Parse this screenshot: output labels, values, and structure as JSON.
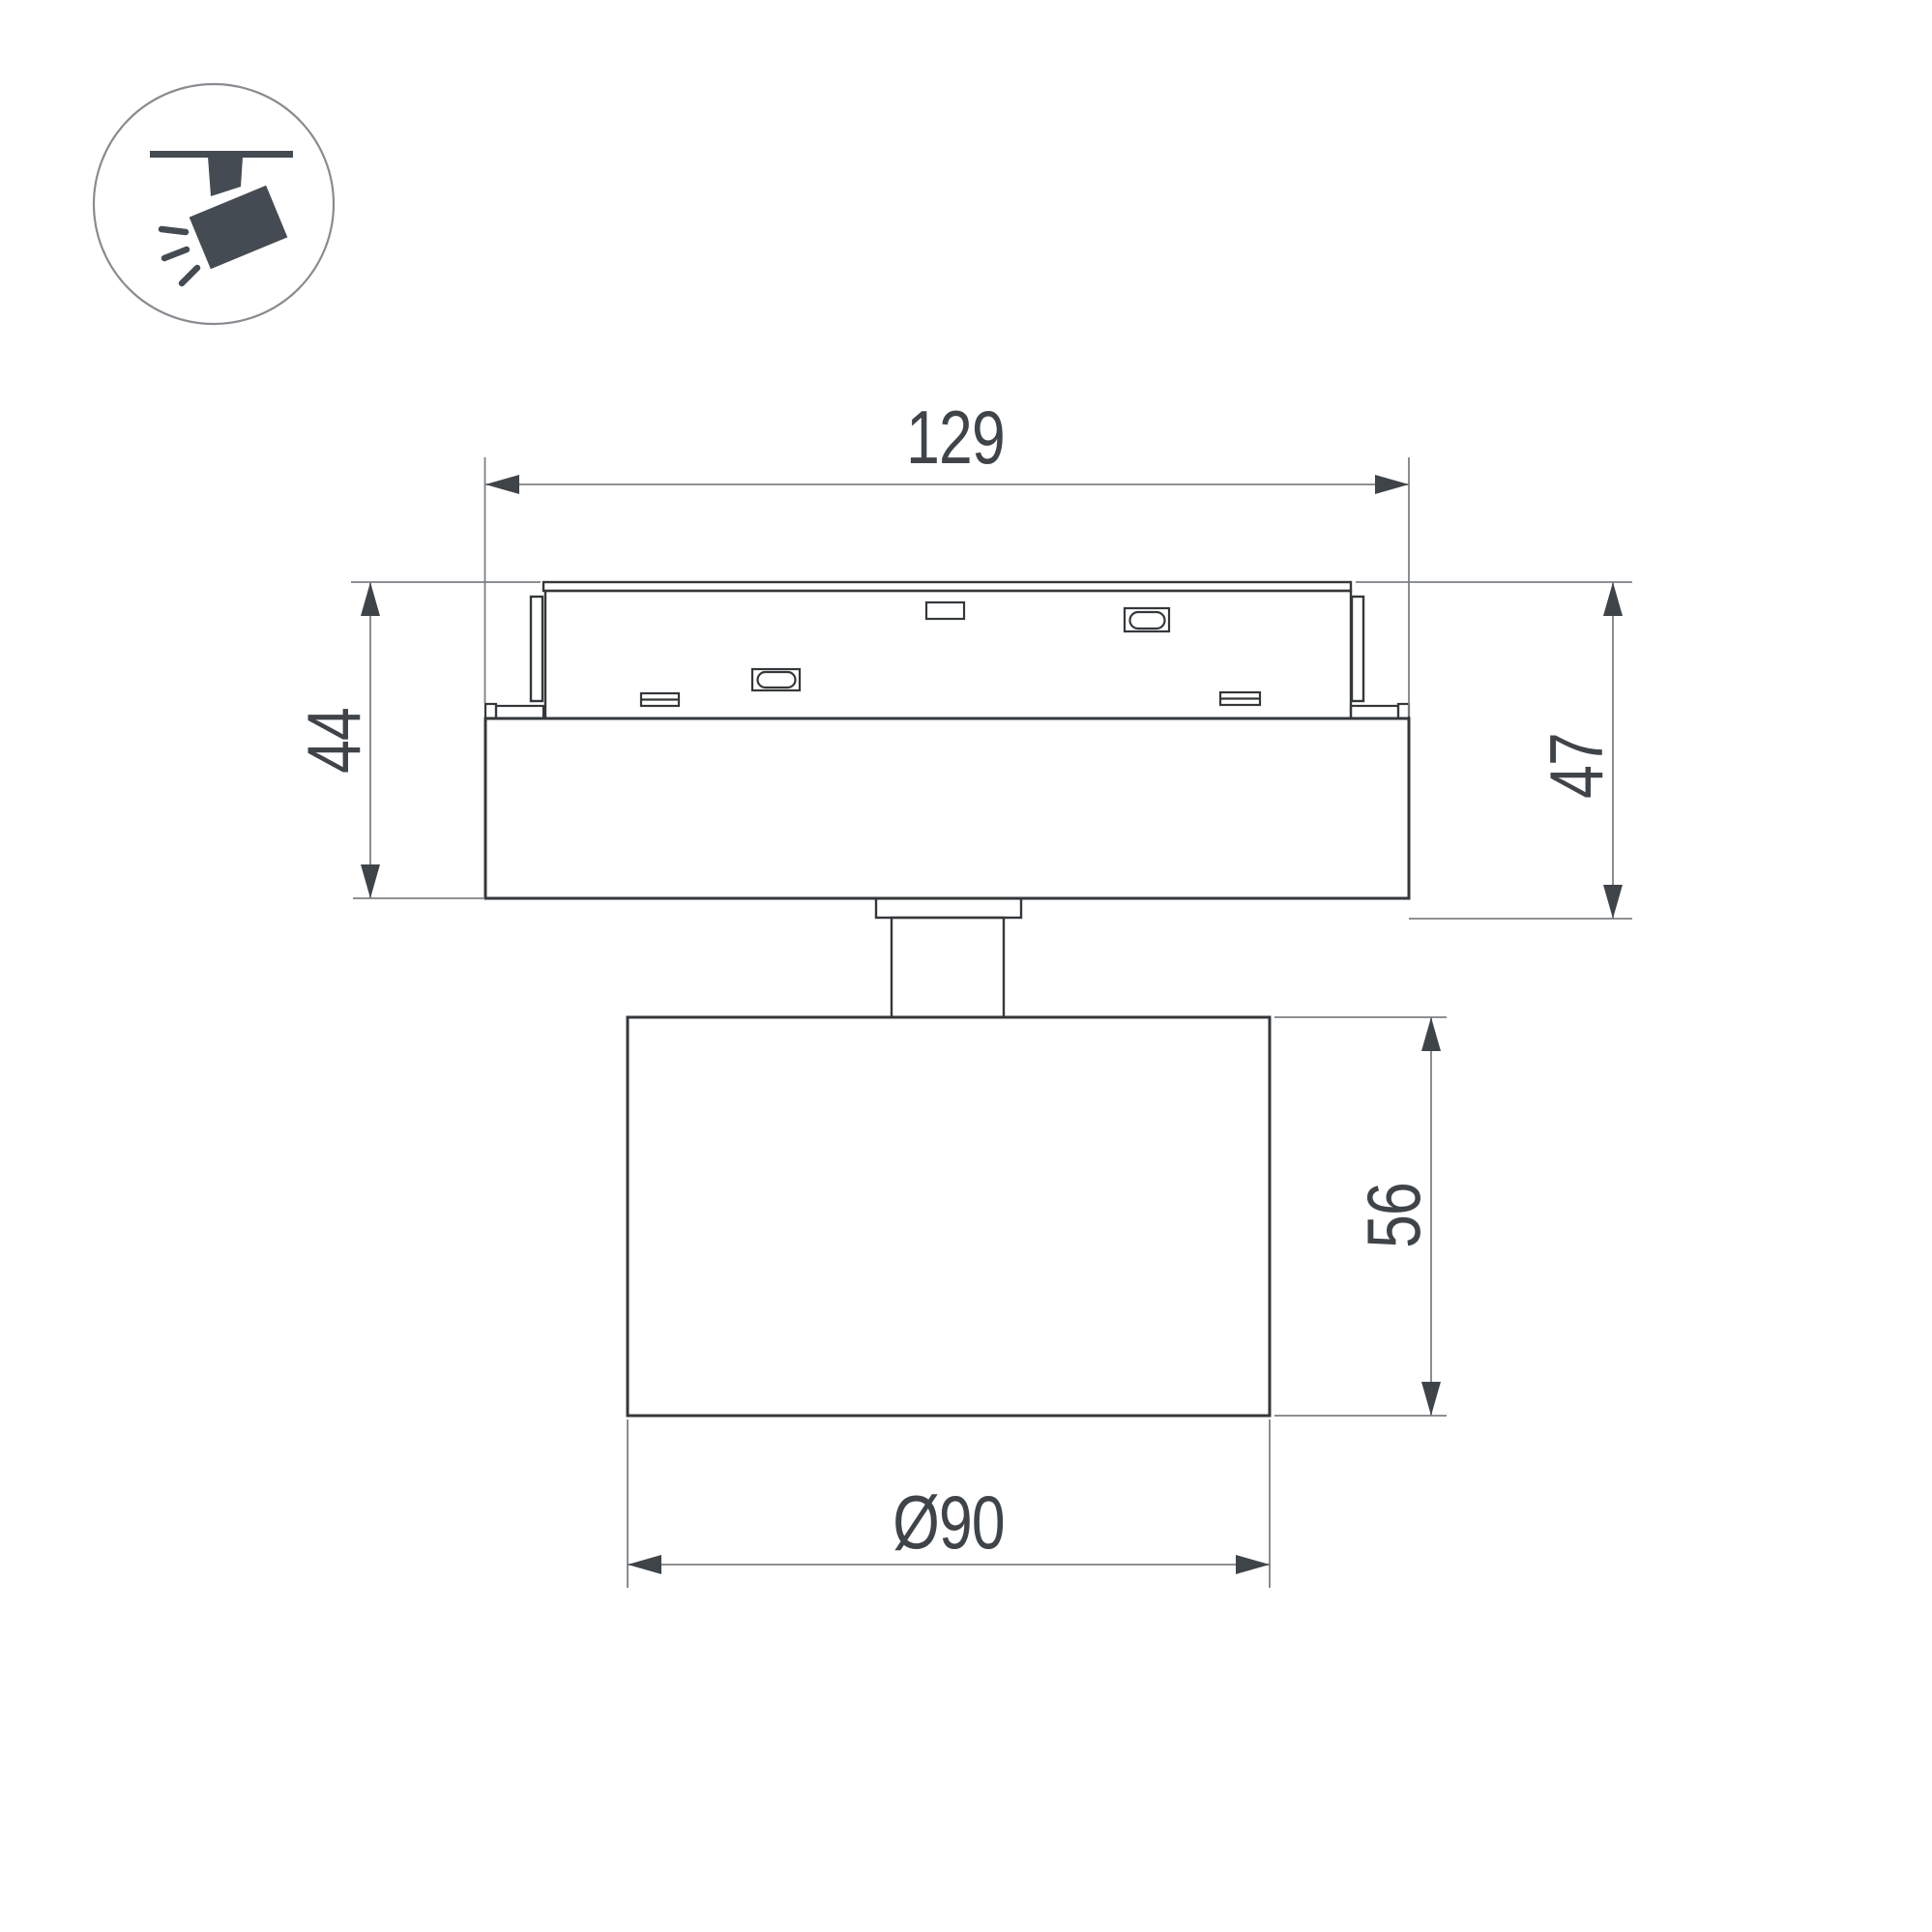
{
  "drawing": {
    "kind": "technical dimension drawing",
    "subject": "magnetic track spotlight, side view"
  },
  "icon": {
    "name": "track-light-icon"
  },
  "dimensions": {
    "adapter_width": {
      "label": "129"
    },
    "adapter_height": {
      "label": "44"
    },
    "overall_height": {
      "label": "47"
    },
    "head_height": {
      "label": "56"
    },
    "head_diameter": {
      "label": "Ø90"
    }
  },
  "colors": {
    "background": "#ffffff",
    "line": "#34383b",
    "dim": "#7d8184",
    "arrow": "#3f4449",
    "icon": "#454b52",
    "ring": "#888c90"
  }
}
